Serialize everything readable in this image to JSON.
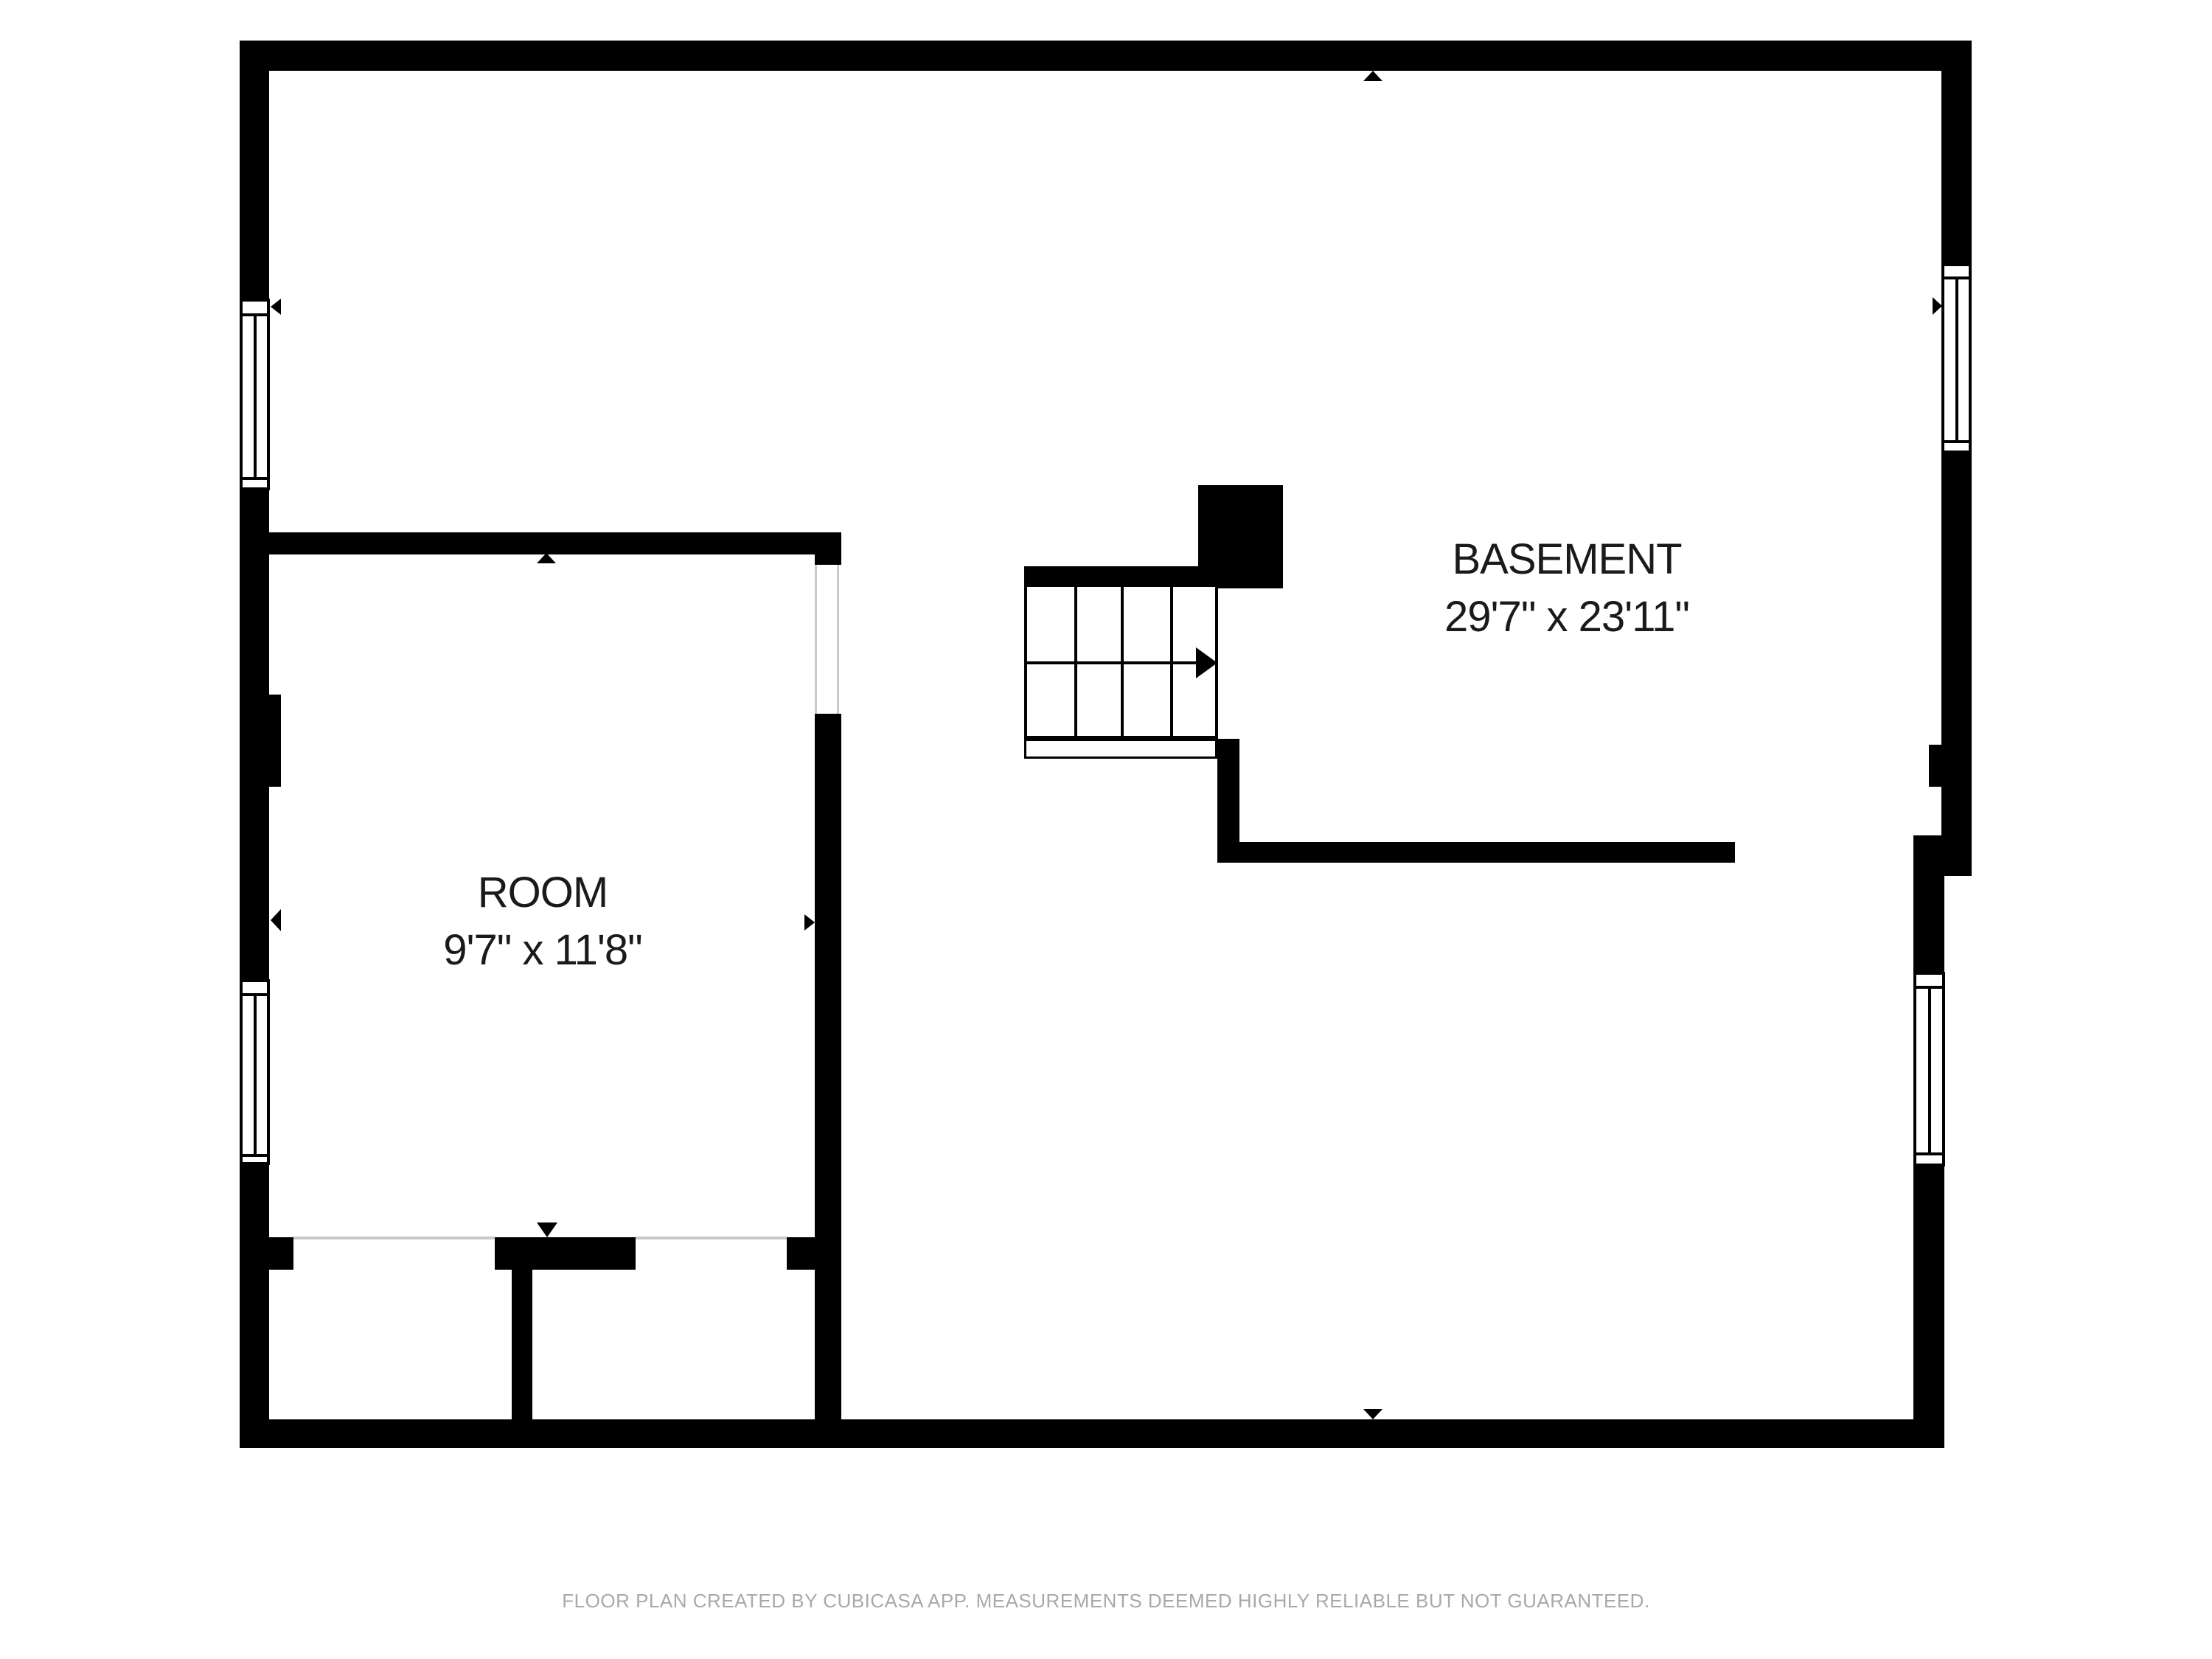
{
  "floor_plan": {
    "rooms": [
      {
        "name": "BASEMENT",
        "dimensions": "29'7\" x 23'11\""
      },
      {
        "name": "ROOM",
        "dimensions": "9'7\" x 11'8\""
      }
    ],
    "footer": "FLOOR PLAN CREATED BY CUBICASA APP. MEASUREMENTS DEEMED HIGHLY RELIABLE BUT NOT GUARANTEED.",
    "icons": [
      "arrow-up-icon",
      "arrow-down-icon",
      "arrow-left-icon",
      "arrow-right-icon",
      "stairs-direction-arrow-icon"
    ],
    "colors": {
      "wall": "#000000",
      "background": "#ffffff",
      "footer_text": "#a9a9a9",
      "opening_line": "#c9c9c9"
    }
  }
}
